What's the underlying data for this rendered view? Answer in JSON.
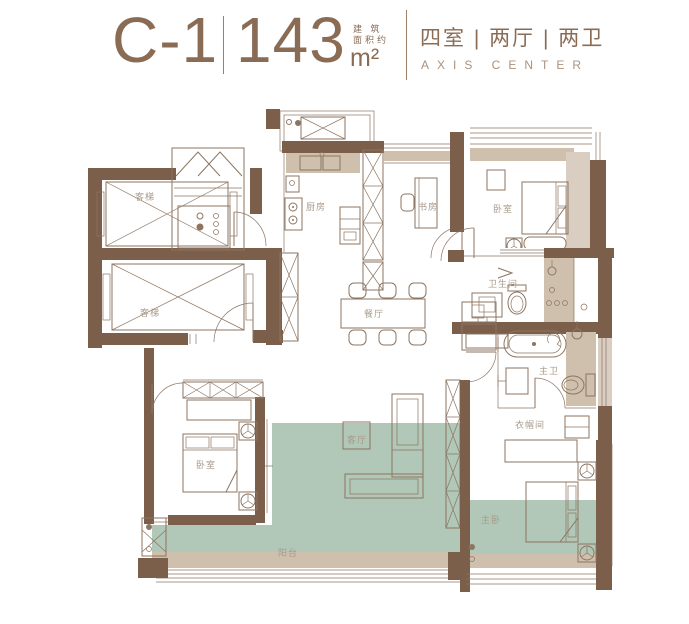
{
  "header": {
    "unit_code": "C-1",
    "area_value": "143",
    "area_prefix": "建 筑\n面积约",
    "area_unit": "m²",
    "layout_text": "四室 | 两厅 | 两卫",
    "brand_text": "AXIS CENTER"
  },
  "plan": {
    "labels": {
      "elevator_top": "客梯",
      "elevator_bottom": "客梯",
      "kitchen": "厨房",
      "study": "书房",
      "bedroom_top": "卧室",
      "bathroom": "卫生间",
      "dining": "餐厅",
      "living": "客厅",
      "bedroom_left": "卧室",
      "master_bath": "主卫",
      "cloakroom": "衣帽间",
      "master_bedroom": "主卧",
      "balcony": "阳台"
    }
  },
  "colors": {
    "wall": "#7c5f4a",
    "line": "#8d7561",
    "tan_fill": "#cfc0ae",
    "green_overlay": "#b1c7b7",
    "accent_text": "#8a6c55"
  }
}
